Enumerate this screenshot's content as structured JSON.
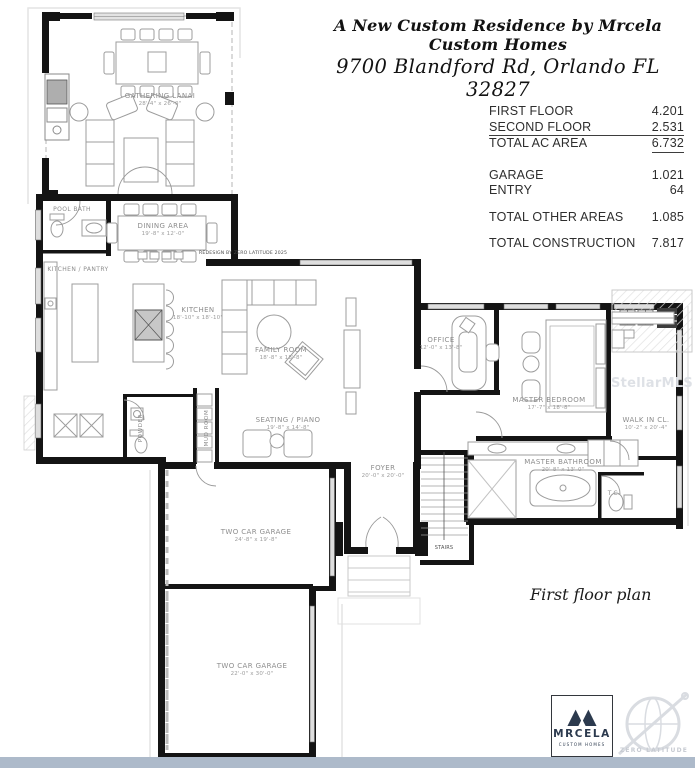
{
  "page": {
    "title_line1": "A New Custom Residence by Mrcela Custom Homes",
    "title_line2": "9700 Blandford Rd, Orlando FL 32827",
    "caption": "First floor plan",
    "redesign_note": "REDESIGN BY ZERO LATITUDE 2025",
    "watermark_text": "StellarMLS",
    "watermark_logo_text": "ZERO LATITUDE"
  },
  "area_table": {
    "rows_ac": [
      {
        "label": "FIRST FLOOR",
        "value": "4.201"
      },
      {
        "label": "SECOND FLOOR",
        "value": "2.531"
      },
      {
        "label": "TOTAL AC AREA",
        "value": "6.732"
      }
    ],
    "rows_other": [
      {
        "label": "GARAGE",
        "value": "1.021"
      },
      {
        "label": "ENTRY",
        "value": "64"
      }
    ],
    "rows_totals": [
      {
        "label": "TOTAL OTHER AREAS",
        "value": "1.085"
      },
      {
        "label": "TOTAL CONSTRUCTION",
        "value": "7.817"
      }
    ]
  },
  "rooms": [
    {
      "label": "GATHERING LANAI",
      "dims": "28'-4\" x 26'-0\""
    },
    {
      "label": "POOL BATH",
      "dims": ""
    },
    {
      "label": "DINING AREA",
      "dims": "19'-8\" x 12'-0\""
    },
    {
      "label": "KITCHEN / PANTRY",
      "dims": ""
    },
    {
      "label": "KITCHEN",
      "dims": "18'-10\" x 18'-10\""
    },
    {
      "label": "FAMILY ROOM",
      "dims": "18'-8\" x 18'-8\""
    },
    {
      "label": "SEATING / PIANO",
      "dims": "19'-8\" x 14'-8\""
    },
    {
      "label": "POWDER",
      "dims": ""
    },
    {
      "label": "MUD ROOM",
      "dims": ""
    },
    {
      "label": "FOYER",
      "dims": "20'-0\" x 20'-0\""
    },
    {
      "label": "OFFICE",
      "dims": "12'-0\" x 13'-8\""
    },
    {
      "label": "MASTER BEDROOM",
      "dims": "17'-7\" x 18'-8\""
    },
    {
      "label": "WALK IN CL.",
      "dims": "10'-2\" x 20'-4\""
    },
    {
      "label": "MASTER BATHROOM",
      "dims": "20'-8\" x 13'-0\""
    },
    {
      "label": "T.C.",
      "dims": ""
    },
    {
      "label": "STAIRS",
      "dims": ""
    },
    {
      "label": "TWO CAR GARAGE",
      "dims": "24'-8\" x 19'-8\""
    },
    {
      "label": "TWO CAR GARAGE",
      "dims": "22'-0\" x 30'-0\""
    }
  ],
  "logo": {
    "name": "MRCELA",
    "tagline": "CUSTOM HOMES"
  },
  "colors": {
    "wall": "#141414",
    "furniture_line": "#9c9c9c",
    "room_label": "#8d8d8d",
    "bottom_bar": "#adbaca",
    "logo_navy": "#2c3a4e",
    "watermark": "#dee1e6"
  }
}
